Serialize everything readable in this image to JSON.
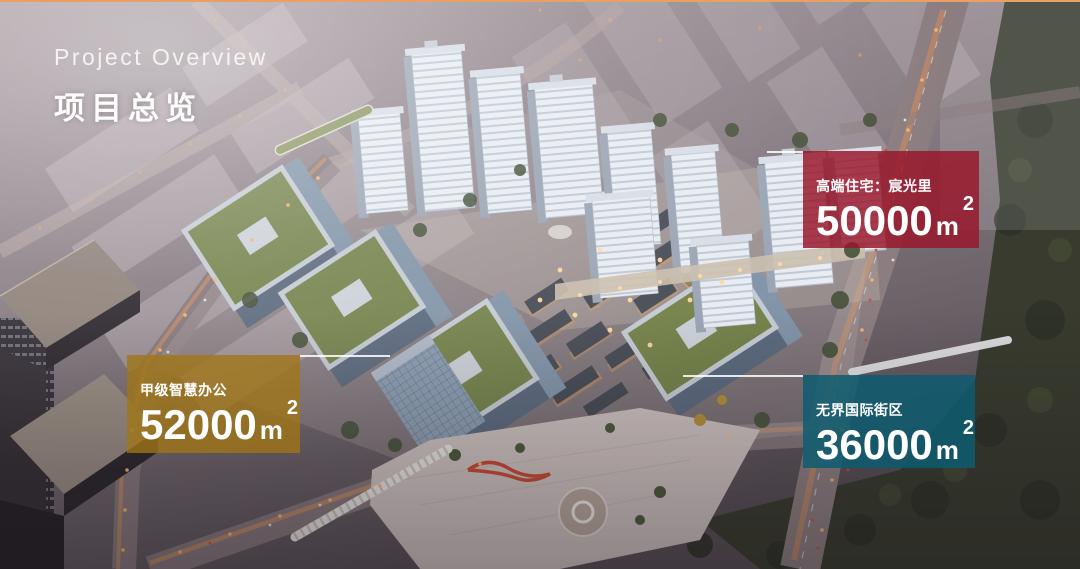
{
  "header": {
    "title_en": "Project Overview",
    "title_zh": "项目总览"
  },
  "accent": {
    "top_border": "#e7a066",
    "leader_line": "rgba(255,255,255,0.85)",
    "residential_color": "rgba(151,22,42,0.83)",
    "office_color": "rgba(160,118,20,0.78)",
    "street_color": "rgba(13,92,112,0.85)"
  },
  "callouts": {
    "residential": {
      "label": "高端住宅：宸光里",
      "value": "50000",
      "unit": "m",
      "sup": "2"
    },
    "office": {
      "label": "甲级智慧办公",
      "value": "52000",
      "unit": "m",
      "sup": "2"
    },
    "street": {
      "label": "无界国际街区",
      "value": "36000",
      "unit": "m",
      "sup": "2"
    }
  },
  "scene": {
    "description": "Aerial dusk rendering of a mixed-use development: white residential towers, green-roof smart offices, lit retail street, ring roads and park trees"
  }
}
